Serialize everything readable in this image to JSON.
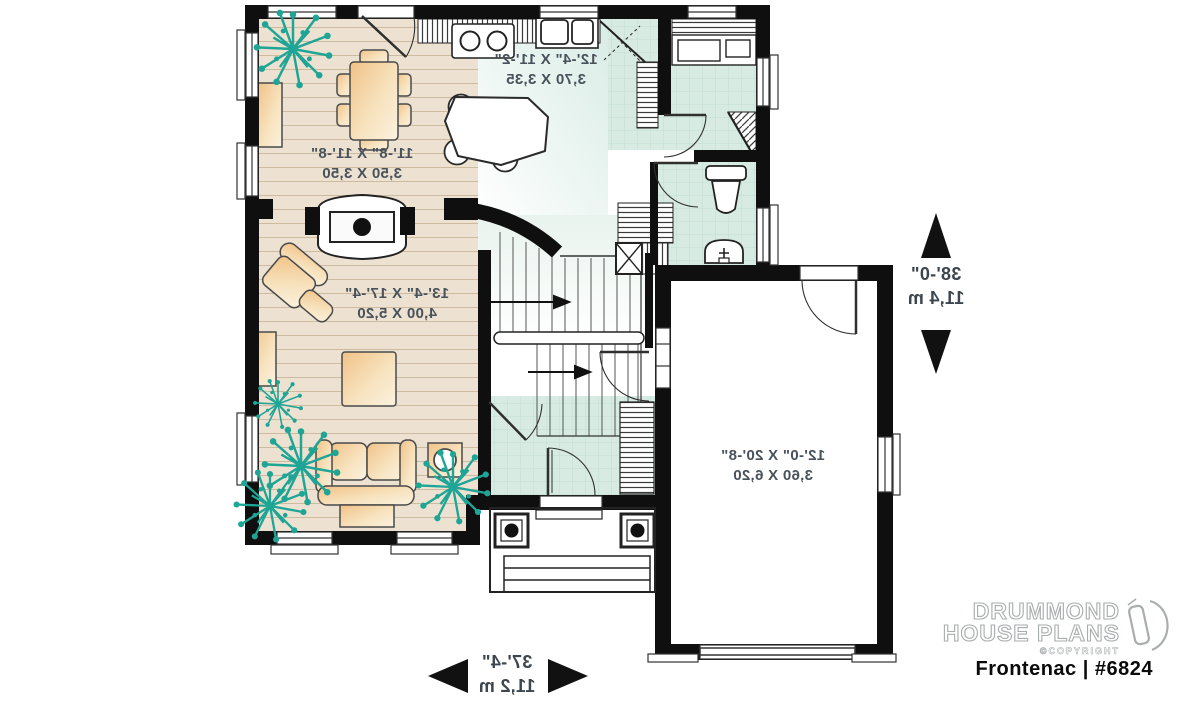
{
  "plan": {
    "rooms": [
      {
        "name": "kitchen",
        "imperial": "12'-4\" X 11'-2\"",
        "metric": "3,70 X 3,35"
      },
      {
        "name": "dining-room",
        "imperial": "11'-8\" X 11'-8\"",
        "metric": "3,50 X 3,50"
      },
      {
        "name": "living-room",
        "imperial": "13'-4\" X 17'-4\"",
        "metric": "4,00 X 5,20"
      },
      {
        "name": "garage",
        "imperial": "12'-0\" X 20'-8\"",
        "metric": "3,60 X 6,20"
      }
    ],
    "overall_depth": {
      "imperial": "38'-0\"",
      "metric": "11,4 m"
    },
    "overall_width": {
      "imperial": "37'-4\"",
      "metric": "11,2 m"
    }
  },
  "branding": {
    "company_line1": "DRUMMOND",
    "company_line2": "HOUSE PLANS",
    "copyright": "©COPYRIGHT",
    "plan_name": "Frontenac | #6824"
  },
  "colors": {
    "wall": "#0f0f0f",
    "wood_floor": "#ede2d2",
    "tile_floor": "#d8ebe3",
    "furniture": "#f1c287",
    "plant": "#1ea595"
  }
}
